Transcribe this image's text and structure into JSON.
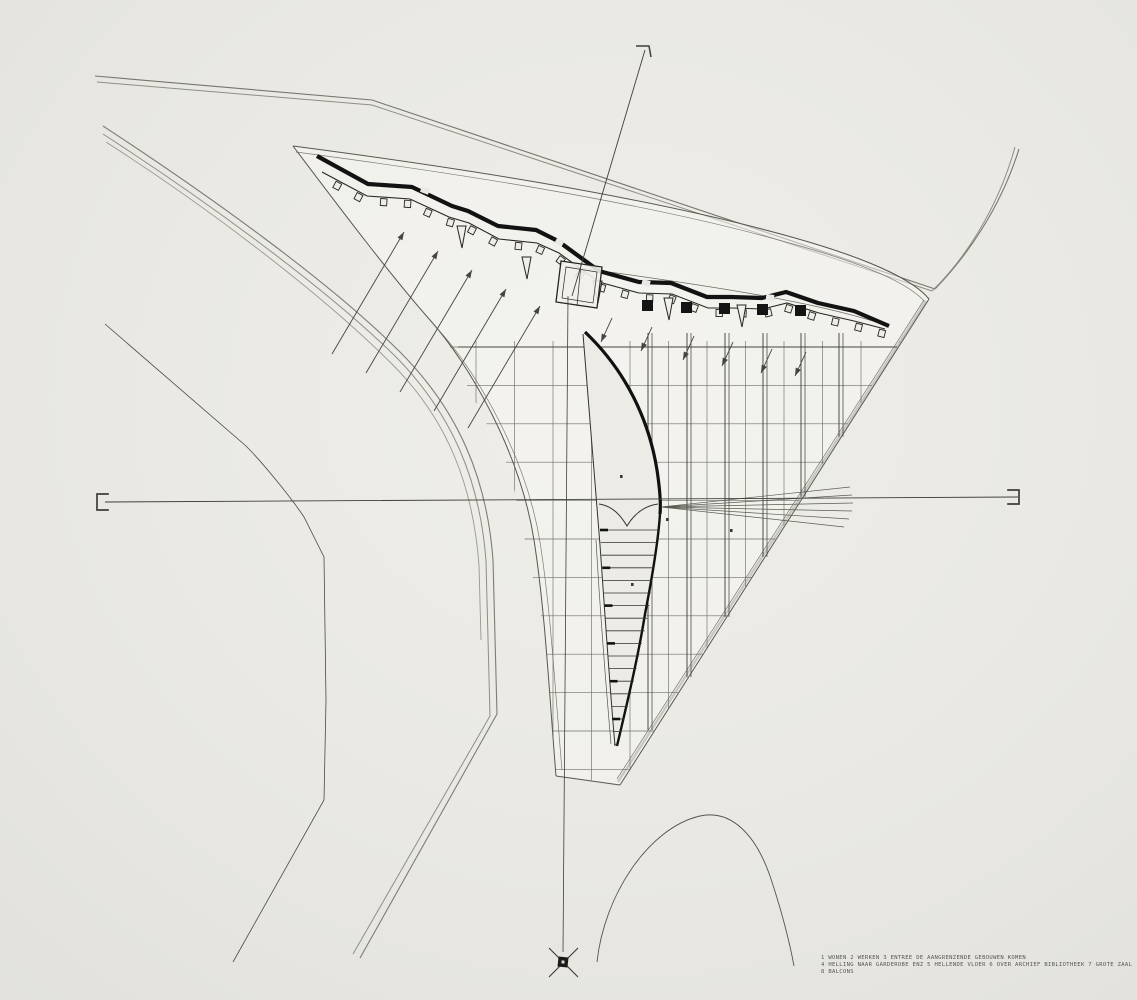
{
  "legend": {
    "line1": "1 WONEN   2 WERKEN   3 ENTREE   DE AANGRENZENDE GEBOUWEN KOMEN",
    "line2": "4 HELLING NAAR GARDEROBE ENZ   5 HELLENDE VLOER   6 OVER ARCHIEF BIBLIOTHEEK 7   GROTE ZAAL",
    "line3": "8 BALCONS"
  },
  "markers": {
    "section_left": "section-cut-marker",
    "section_right": "section-cut-marker",
    "section_top": "section-cut-marker",
    "datum": "crossed-datum-marker"
  },
  "colors": {
    "paper": "#e9e8e3",
    "paper_light": "#eeede8",
    "paper_dark": "#e2e1dc",
    "ink": "#2e2d2a",
    "wall_ink": "#121212",
    "road_gray": "#84837c",
    "light_band": "#c8c7c1"
  }
}
